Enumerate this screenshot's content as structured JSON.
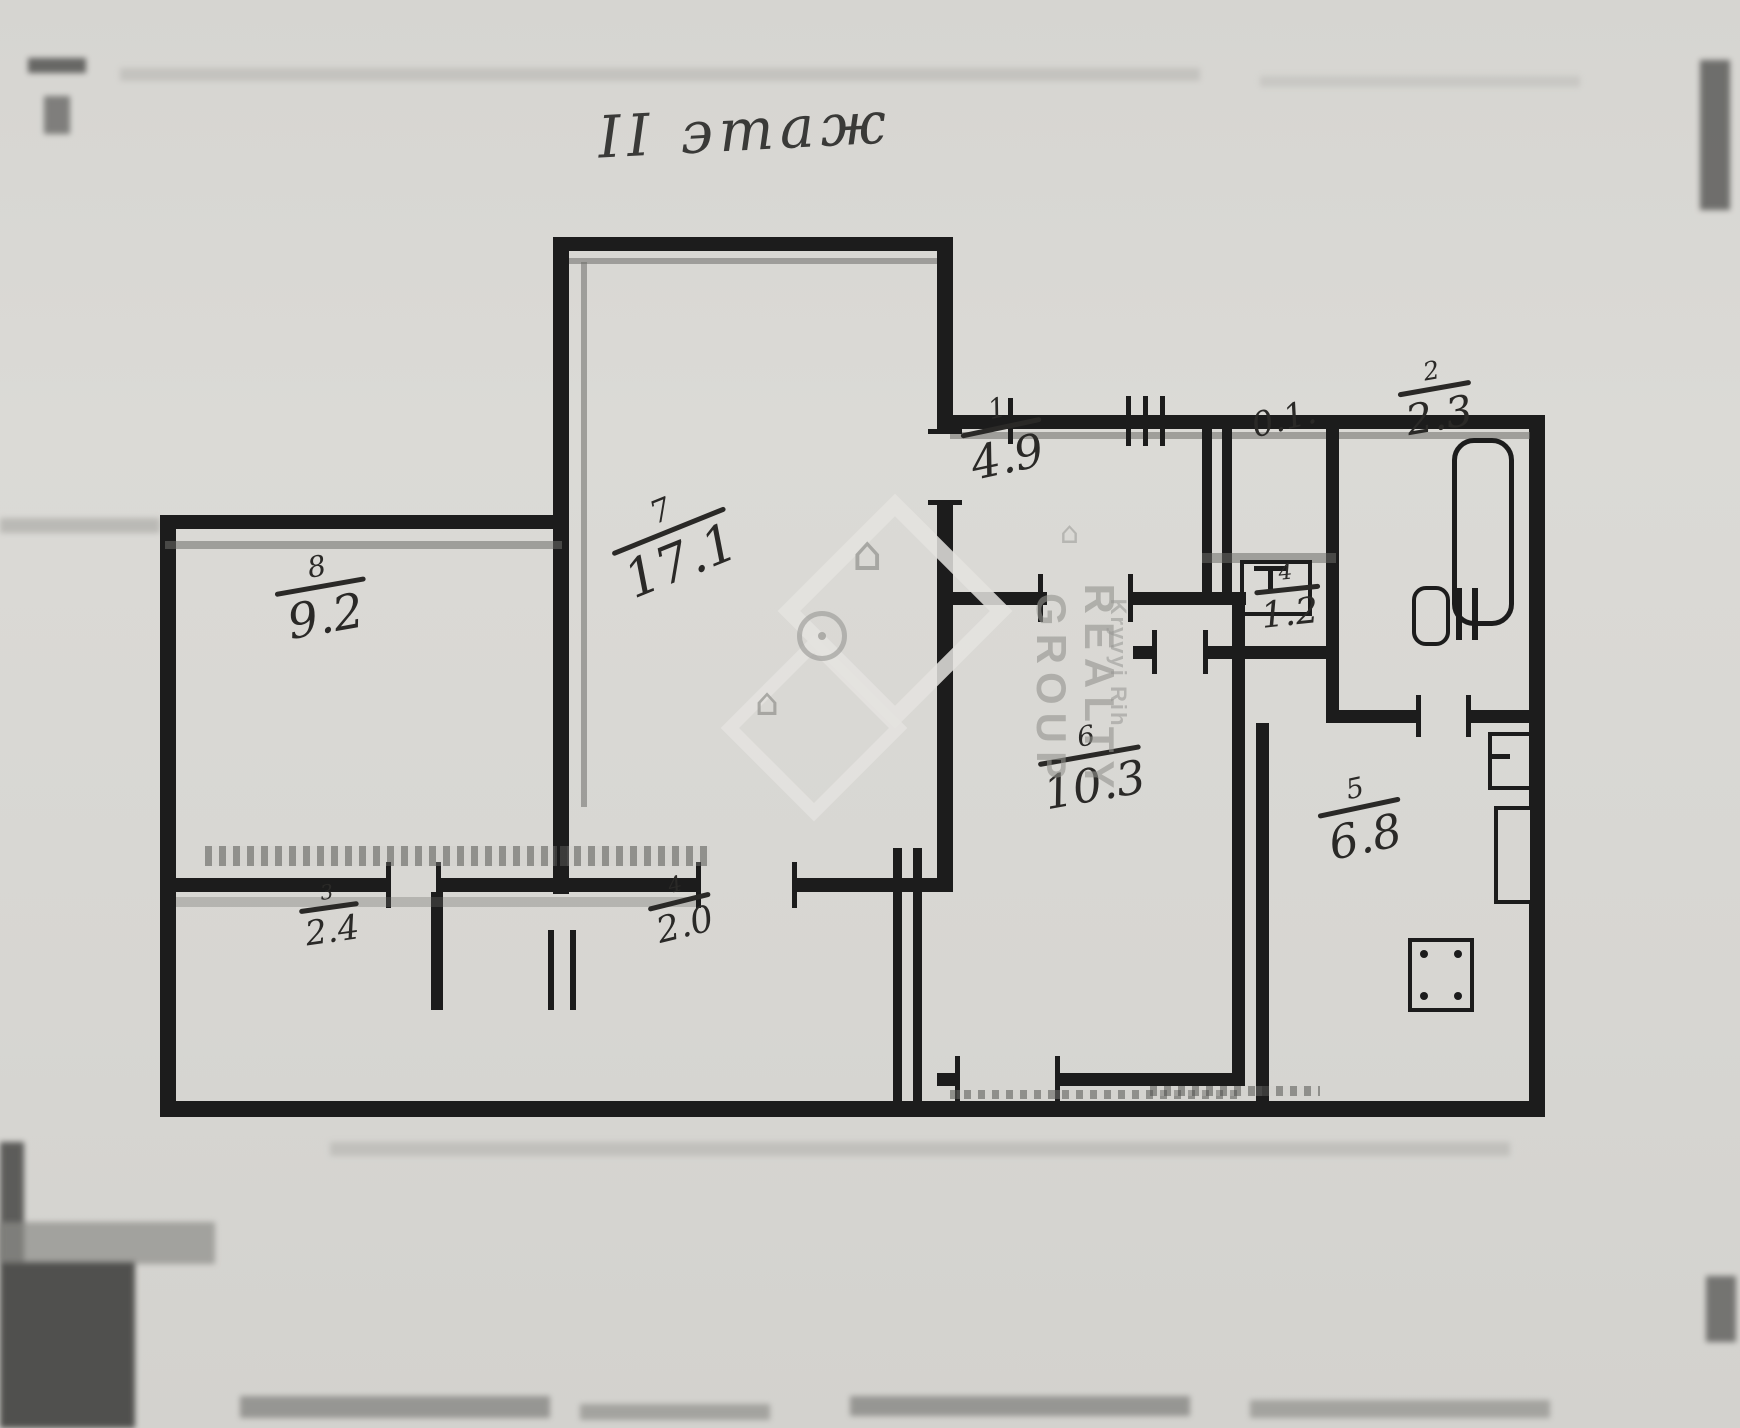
{
  "title": "II этаж",
  "rooms": [
    {
      "number": "8",
      "area": "9.2"
    },
    {
      "number": "7",
      "area": "17.1"
    },
    {
      "number": "1",
      "area": "4.9"
    },
    {
      "number": "",
      "area": "0.1."
    },
    {
      "number": "2",
      "area": "2.3"
    },
    {
      "number": "4",
      "area": "1.2"
    },
    {
      "number": "6",
      "area": "10.3"
    },
    {
      "number": "5",
      "area": "6.8"
    },
    {
      "number": "3",
      "area": "2.4"
    },
    {
      "number": "4",
      "area": "2.0"
    }
  ],
  "watermark": {
    "brand": "REALTY GROUP",
    "city": "Kryvyi Rih",
    "house_glyph": "⌂"
  },
  "icons": {
    "bathtub-icon": "vertical rounded rectangle outline",
    "washbasin-icon": "small rectangle with T mark",
    "toilet-icon": "circle with twin bars",
    "stove-icon": "square with four dots",
    "sink-icon": "small rectangle with divider",
    "vent-duct": "small wall rectangle"
  },
  "colors": {
    "ink": "#1c1c1c",
    "paper": "#d8d7d3",
    "print_gray": "#6e6d69",
    "watermark": "#949490"
  }
}
